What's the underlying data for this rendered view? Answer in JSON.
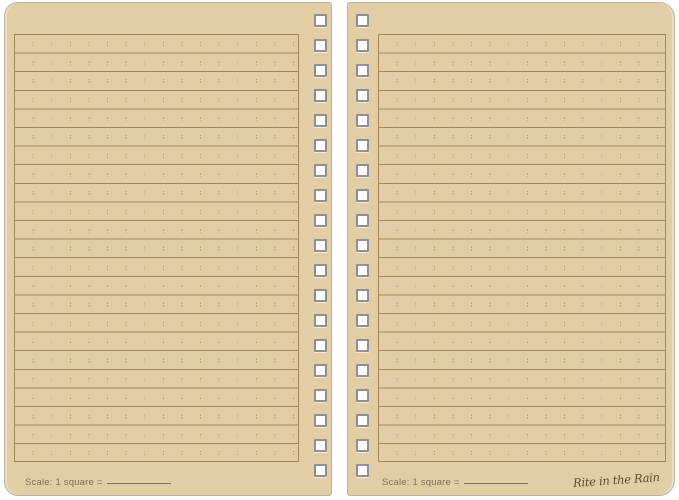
{
  "left_page": {
    "scale_label": "Scale: 1 square ="
  },
  "right_page": {
    "scale_label": "Scale: 1 square =",
    "brand_signature": "Rite in the Rain"
  },
  "binding": {
    "holes_per_page": 19
  },
  "colors": {
    "page": "#e3cda4",
    "rule_line": "#a3875a",
    "grid_tick": "#b59a6e",
    "page_edge": "#b9b1a2",
    "hole_border": "#8f8f8f",
    "hole_fill": "#ffffff",
    "scale_text": "#7e6f55",
    "signature": "#5c4731",
    "background": "#ffffff"
  }
}
